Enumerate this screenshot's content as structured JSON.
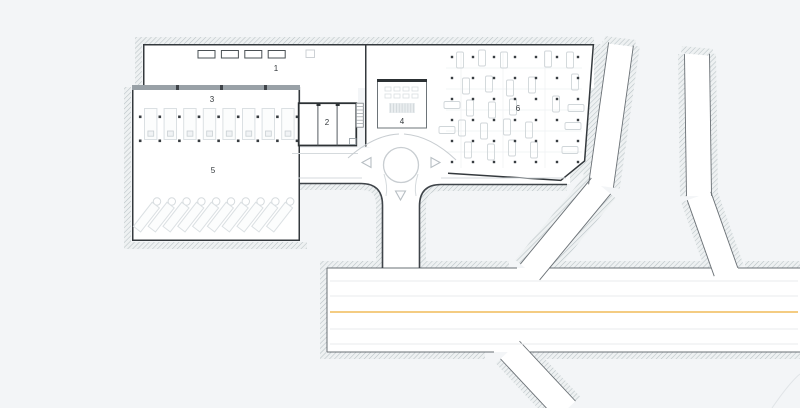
{
  "plan": {
    "type": "architectural-site-plan",
    "zones": [
      {
        "id": "zone-1",
        "label": "1",
        "x": 276,
        "y": 69
      },
      {
        "id": "zone-2",
        "label": "2",
        "x": 327,
        "y": 123
      },
      {
        "id": "zone-3",
        "label": "3",
        "x": 212,
        "y": 100
      },
      {
        "id": "zone-4",
        "label": "4",
        "x": 402,
        "y": 122
      },
      {
        "id": "zone-5",
        "label": "5",
        "x": 213,
        "y": 171
      },
      {
        "id": "zone-6",
        "label": "6",
        "x": 518,
        "y": 109
      }
    ],
    "colors": {
      "background": "#f3f5f7",
      "road_white": "#ffffff",
      "outline_dark": "#34393d",
      "curb_dark": "#3f4449",
      "road_edge": "#6a7075",
      "hatch_line": "#b9c2c6",
      "hatch_base": "#eef1f2",
      "center_line_yellow": "#f1bc59",
      "lane_line": "#e8ebed",
      "wall_gray": "#99a1a7",
      "faint_gray": "#d5dadd",
      "stall_line": "#dbe0e3",
      "car_line": "#d0d6d9",
      "column_dot": "#383d41",
      "arrow_gray": "#b7bec3",
      "circle_gray": "#c8cdd1"
    },
    "parking": {
      "area3": {
        "stalls": 8,
        "dots_per_row": 9,
        "dot_rows": 2
      },
      "area5": {
        "stalls": 10
      },
      "area6": {
        "grid_cols": 7,
        "grid_rows": 6,
        "cars": [
          [
            460,
            60,
            "v"
          ],
          [
            482,
            58,
            "v"
          ],
          [
            504,
            60,
            "v"
          ],
          [
            548,
            59,
            "v"
          ],
          [
            570,
            60,
            "v"
          ],
          [
            466,
            86,
            "v"
          ],
          [
            489,
            84,
            "v"
          ],
          [
            510,
            88,
            "v"
          ],
          [
            532,
            85,
            "v"
          ],
          [
            575,
            82,
            "v"
          ],
          [
            452,
            105,
            "h"
          ],
          [
            470,
            108,
            "v"
          ],
          [
            492,
            110,
            "v"
          ],
          [
            513,
            107,
            "v"
          ],
          [
            556,
            104,
            "v"
          ],
          [
            576,
            108,
            "h"
          ],
          [
            447,
            130,
            "h"
          ],
          [
            462,
            128,
            "v"
          ],
          [
            484,
            131,
            "v"
          ],
          [
            507,
            127,
            "v"
          ],
          [
            529,
            130,
            "v"
          ],
          [
            573,
            126,
            "h"
          ],
          [
            468,
            150,
            "v"
          ],
          [
            491,
            152,
            "v"
          ],
          [
            512,
            148,
            "v"
          ],
          [
            534,
            150,
            "v"
          ],
          [
            570,
            150,
            "h"
          ]
        ]
      }
    },
    "skylights": {
      "count": 4
    },
    "roundabout": {
      "arrows": [
        "left",
        "right",
        "down"
      ]
    }
  }
}
